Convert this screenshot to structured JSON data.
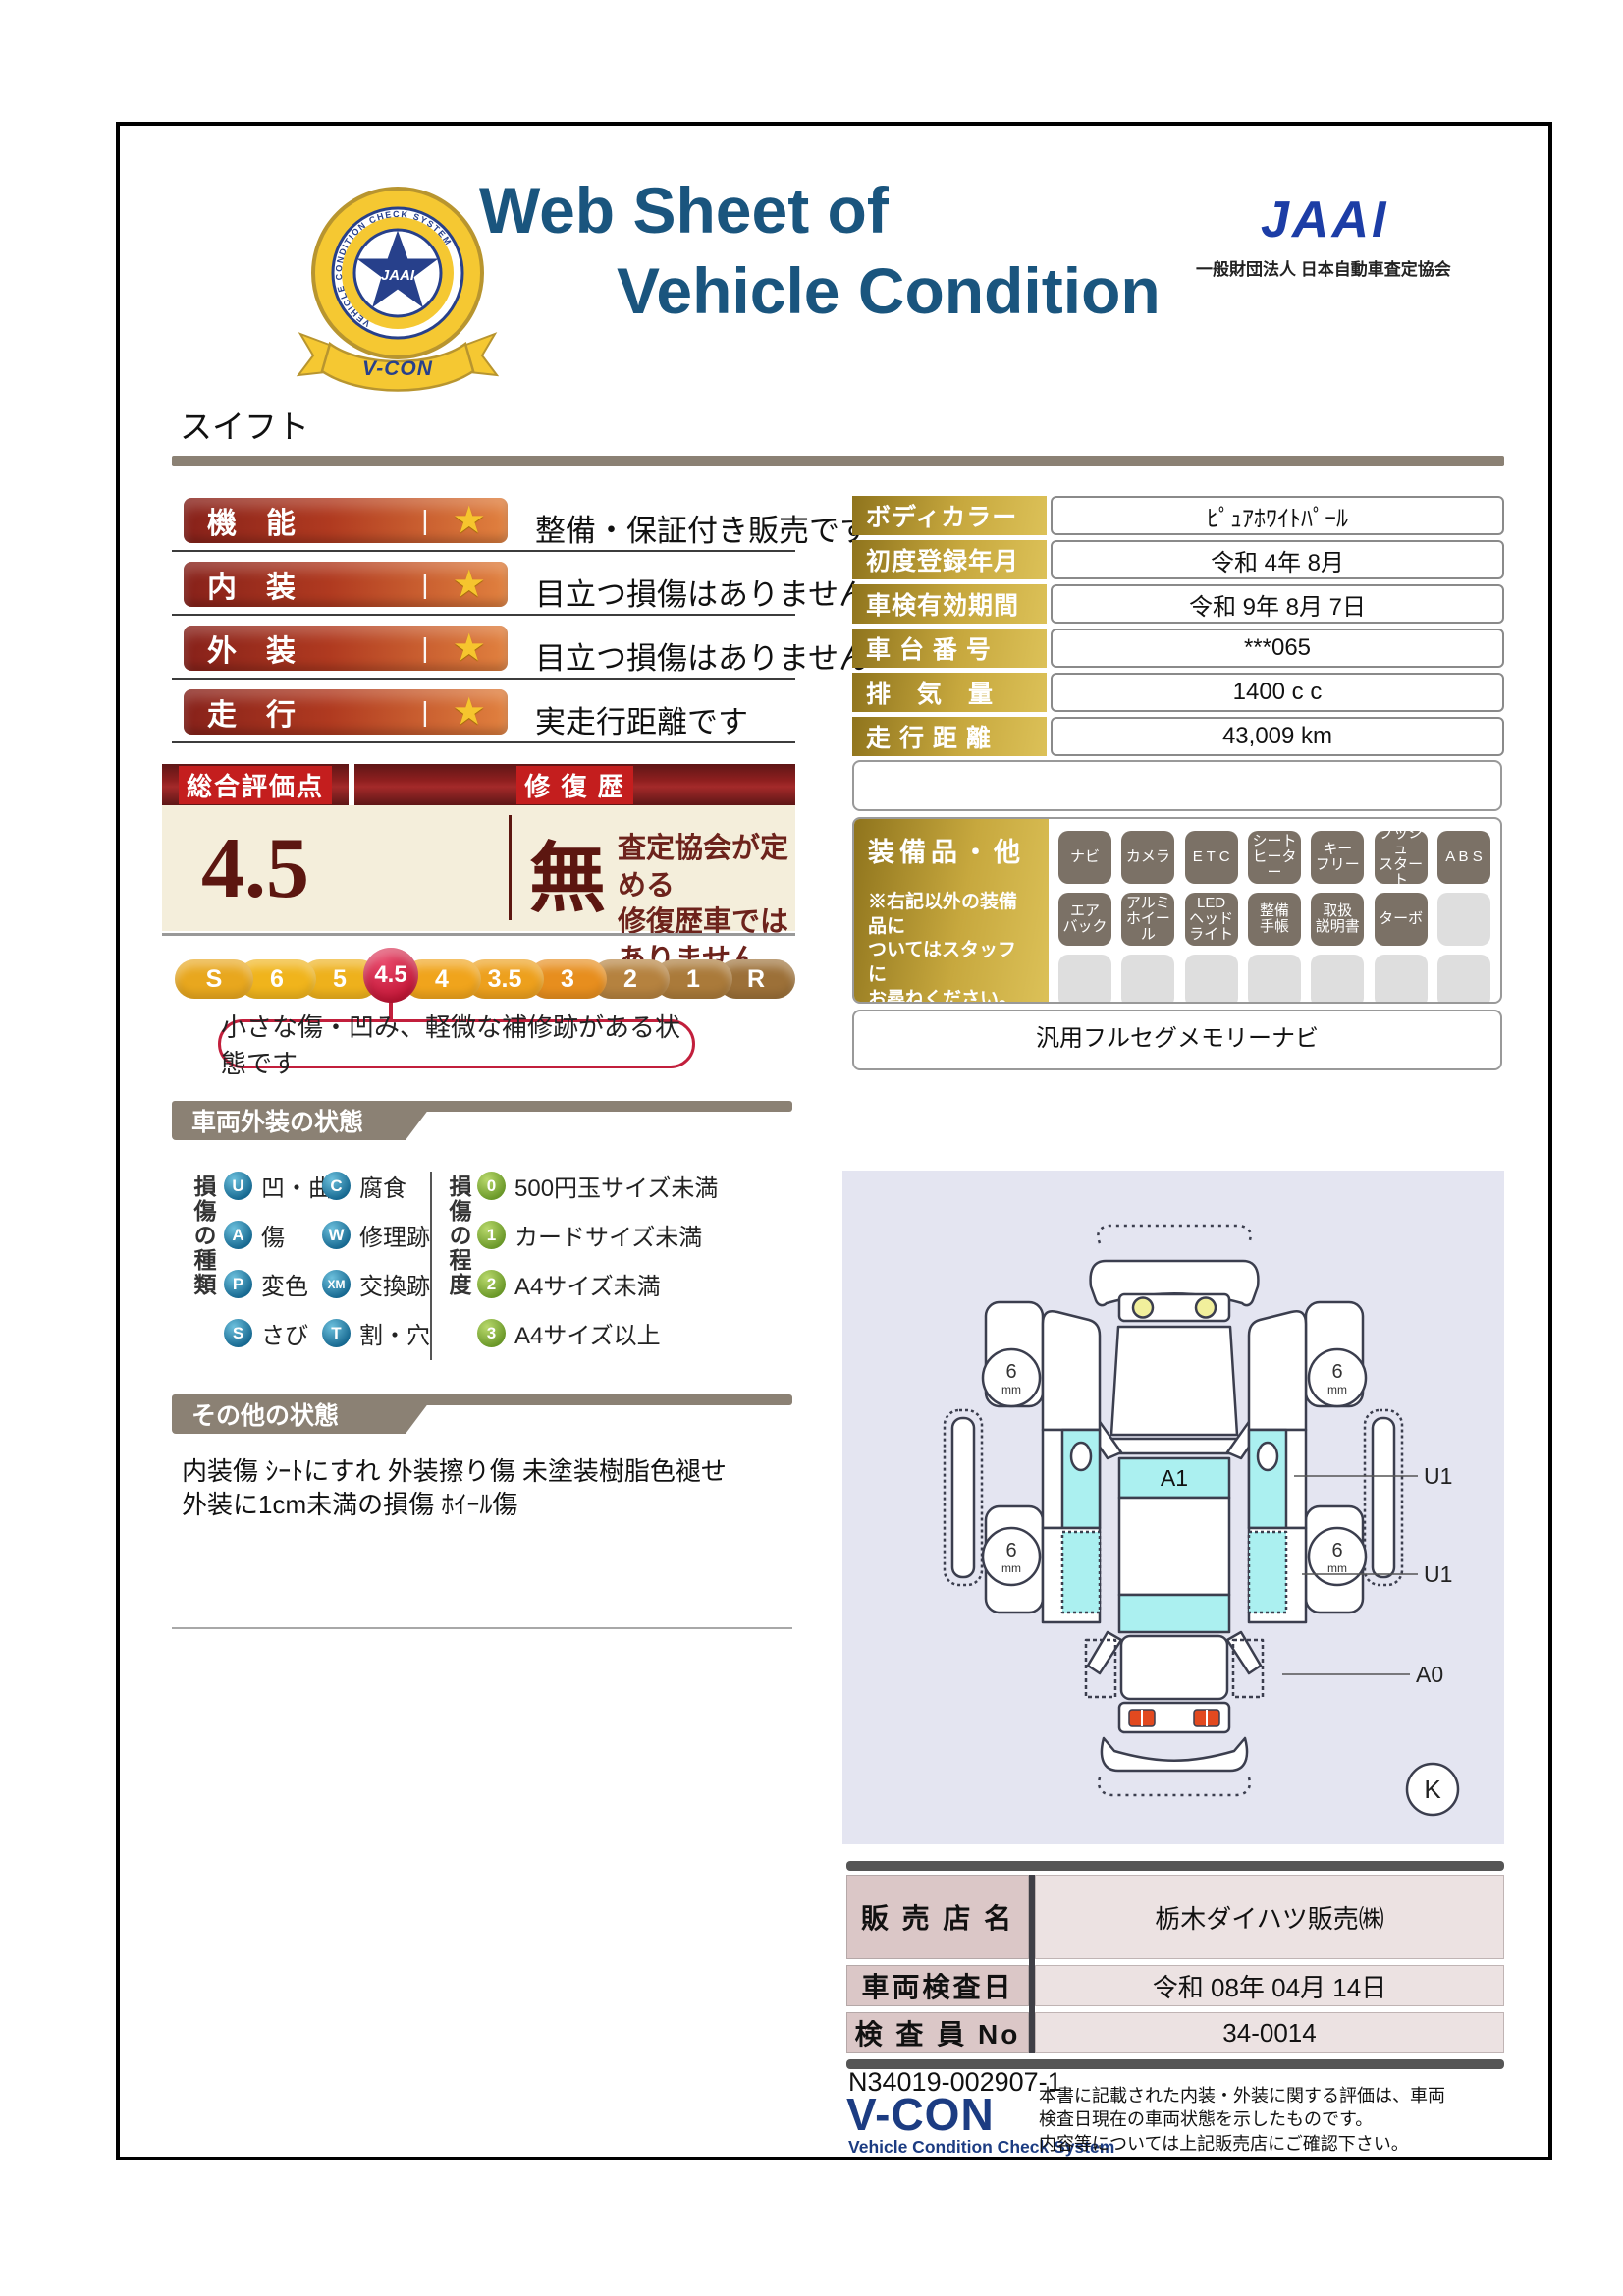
{
  "colors": {
    "title_blue": "#1a557e",
    "jaai_blue": "#1c3da6",
    "taupe_bar": "#8b8174",
    "rating_bar_red": "#87211a",
    "gold": "#b08f2a",
    "maroon": "#5c1610",
    "score_crimson": "#c11434",
    "badge_active": "#7b7166",
    "badge_empty": "#dedede",
    "legend_blue": "#15678f",
    "legend_green": "#689627",
    "diagram_bg": "#e4e5f1",
    "diagram_cyan": "#abf0f0",
    "dealer_label_pink": "#dbc7c7",
    "vcon_navy": "#1c3c82"
  },
  "header": {
    "title_line1": "Web Sheet of",
    "title_line2": "Vehicle Condition",
    "jaai_logo": "JAAI",
    "jaai_org": "一般財団法人 日本自動車査定協会",
    "emblem": {
      "ring_text": "VEHICLE CONDITION CHECK SYSTEM",
      "star_text": "JAAI",
      "ribbon": "V-CON"
    }
  },
  "vehicle_name": "スイフト",
  "ratings": {
    "star": "★",
    "separator": "|",
    "items": [
      {
        "label": "機　能",
        "desc": "整備・保証付き販売です"
      },
      {
        "label": "内　装",
        "desc": "目立つ損傷はありません"
      },
      {
        "label": "外　装",
        "desc": "目立つ損傷はありません"
      },
      {
        "label": "走　行",
        "desc": "実走行距離です"
      }
    ]
  },
  "spec_table": [
    {
      "label": "ボディカラー",
      "value": "ﾋﾟｭｱﾎﾜｲﾄﾊﾟｰﾙ"
    },
    {
      "label": "初度登録年月",
      "value": "令和 4年 8月"
    },
    {
      "label": "車検有効期間",
      "value": "令和 9年 8月 7日"
    },
    {
      "label": "車 台 番 号",
      "value": "***065"
    },
    {
      "label": "排　気　量",
      "value": "1400 c c"
    },
    {
      "label": "走 行 距 離",
      "value": "43,009 km"
    }
  ],
  "overall": {
    "header_left": "総合評価点",
    "header_right": "修 復 歴",
    "score": "4.5",
    "repair": "無",
    "repair_desc": "査定協会が定める\n修復歴車ではありません",
    "scale": [
      "S",
      "6",
      "5",
      "4.5",
      "4",
      "3.5",
      "3",
      "2",
      "1",
      "R"
    ],
    "selected": "4.5",
    "callout": "小さな傷・凹み、軽微な補修跡がある状態です"
  },
  "equipment": {
    "title": "装備品・他",
    "note": "※右記以外の装備品に\nついてはスタッフに\nお尋ねください。",
    "badges": [
      "ナビ",
      "カメラ",
      "E T C",
      "シート\nヒーター",
      "キー\nフリー",
      "プッシュ\nスタート",
      "A B S",
      "エア\nバック",
      "アルミ\nホイール",
      "LED\nヘッド\nライト",
      "整備\n手帳",
      "取扱\n説明書",
      "ターボ"
    ],
    "nav_note": "汎用フルセグメモリーナビ"
  },
  "exterior_section": {
    "title": "車両外装の状態",
    "type_label": "損傷の種類",
    "types": [
      {
        "code": "U",
        "label": "凹・曲"
      },
      {
        "code": "A",
        "label": "傷"
      },
      {
        "code": "P",
        "label": "変色"
      },
      {
        "code": "S",
        "label": "さび"
      },
      {
        "code": "C",
        "label": "腐食"
      },
      {
        "code": "W",
        "label": "修理跡"
      },
      {
        "code": "XM",
        "label": "交換跡"
      },
      {
        "code": "T",
        "label": "割・穴"
      }
    ],
    "degree_label": "損傷の程度",
    "degrees": [
      {
        "code": "0",
        "label": "500円玉サイズ未満"
      },
      {
        "code": "1",
        "label": "カードサイズ未満"
      },
      {
        "code": "2",
        "label": "A4サイズ未満"
      },
      {
        "code": "3",
        "label": "A4サイズ以上"
      }
    ]
  },
  "other_section": {
    "title": "その他の状態",
    "text": "内装傷 ｼｰﾄにすれ 外装擦り傷 未塗装樹脂色褪せ\n外装に1cm未満の損傷 ﾎｲｰﾙ傷"
  },
  "diagram": {
    "a1": "A1",
    "u1_top": "U1",
    "u1_mid": "U1",
    "a0": "A0",
    "k": "K",
    "wheel_value": "6",
    "wheel_unit": "mm"
  },
  "dealer_table": [
    {
      "label": "販 売 店 名",
      "value": "栃木ダイハツ販売㈱"
    },
    {
      "label": "車両検査日",
      "value": "令和 08年 04月 14日"
    },
    {
      "label": "検 査 員 No",
      "value": "34-0014"
    }
  ],
  "footer": {
    "doc_number": "N34019-002907-1",
    "vcon": "V-CON",
    "vcon_sub": "Vehicle Condition Check System",
    "disclaimer": "本書に記載された内装・外装に関する評価は、車両\n検査日現在の車両状態を示したものです。\n内容等については上記販売店にご確認下さい。"
  }
}
